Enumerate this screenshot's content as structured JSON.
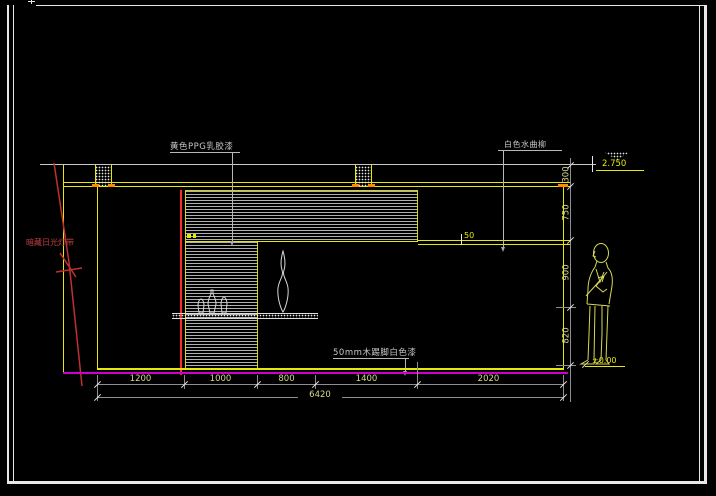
{
  "drawing_type": "interior-elevation-cad",
  "colors": {
    "background": "#000000",
    "line_yellow": "#E8E808",
    "line_gray": "#8F8F8F",
    "line_white": "#E8E8E8",
    "line_magenta": "#CC00CC",
    "line_red": "#FF2A2A",
    "leader_red": "#C24040",
    "tick_orange": "#FF8C00",
    "dim_text": "#D9D98A"
  },
  "annotations": {
    "wall_paint_label": "黄色PPG乳胶漆",
    "ledge_finish_label": "白色水曲柳",
    "skirting_label": "50mm木踢脚白色漆",
    "light_strip_label": "暗藏日光灯带",
    "ledge_thickness_label": "50"
  },
  "elevation_markers": {
    "top": "2.750",
    "bottom": "±0.00"
  },
  "dimensions": {
    "bottom_segments": [
      "1200",
      "1000",
      "800",
      "1400",
      "2020"
    ],
    "bottom_total": "6420",
    "right_segments": [
      "300",
      "750",
      "900",
      "820"
    ]
  }
}
